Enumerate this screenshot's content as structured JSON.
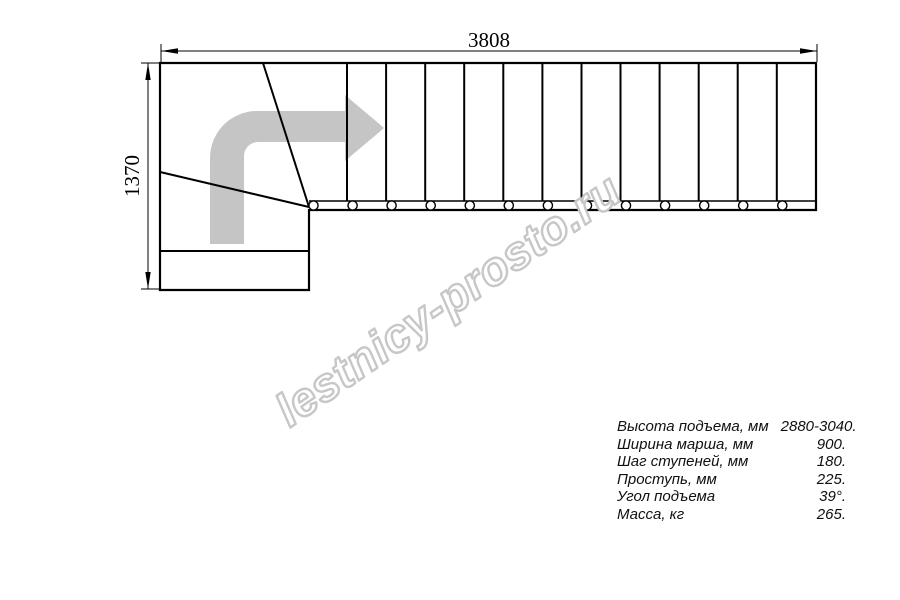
{
  "drawing": {
    "width_label": "3808",
    "height_label": "1370",
    "line_color": "#000000",
    "arrow_color": "#c5c5c5",
    "arrow_icon": "turn-right-arrow"
  },
  "watermark": {
    "text": "lestnicy-prosto.ru",
    "outline_color": "#c7c7c7",
    "fill_color": "#ffffff"
  },
  "specs": {
    "rows": [
      {
        "label": "Высота подъема, мм",
        "value": "2880-3040."
      },
      {
        "label": "Ширина марша, мм",
        "value": "900."
      },
      {
        "label": "Шаг ступеней, мм",
        "value": "180."
      },
      {
        "label": "Проступь, мм",
        "value": "225."
      },
      {
        "label": "Угол подъема",
        "value": "39°."
      },
      {
        "label": "Масса, кг",
        "value": "265."
      }
    ]
  }
}
